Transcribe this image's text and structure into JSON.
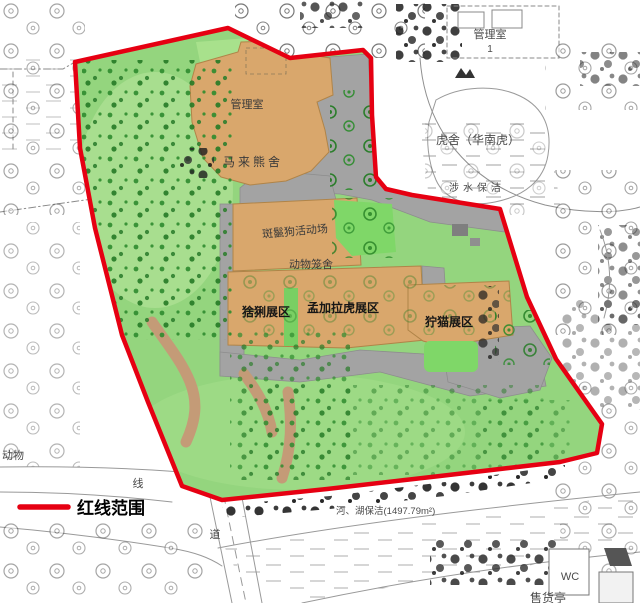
{
  "legend": {
    "label": "红线范围",
    "line_color": "#e60012"
  },
  "labels": {
    "mgmt_inner": "管理室",
    "bear_house": "马来熊舍",
    "hyena_field": "斑鬣狗活动场",
    "animal_cages": "动物笼舍",
    "lynx_zone": "猞猁展区",
    "bengal_tiger_zone": "孟加拉虎展区",
    "caracal_zone": "狞猫展区",
    "mgmt_outer": "管理室",
    "mgmt_outer_num": "1",
    "tiger_house": "虎舍（华南虎）",
    "wading_cleaning": "涉水保洁",
    "river_cleaning": "河、湖保洁(1497.79m²)",
    "wc": "WC",
    "animal_partial": "动物",
    "road_char_xian": "线",
    "road_char_dao": "道",
    "kiosk": "售货亭"
  },
  "colors": {
    "boundary_red": "#e60012",
    "greenspace": "#94d57e",
    "bright_green": "#7fd768",
    "building_tan": "#d9a76c",
    "path_grey": "#a3a3a3",
    "trail_brown": "#c49b77"
  }
}
